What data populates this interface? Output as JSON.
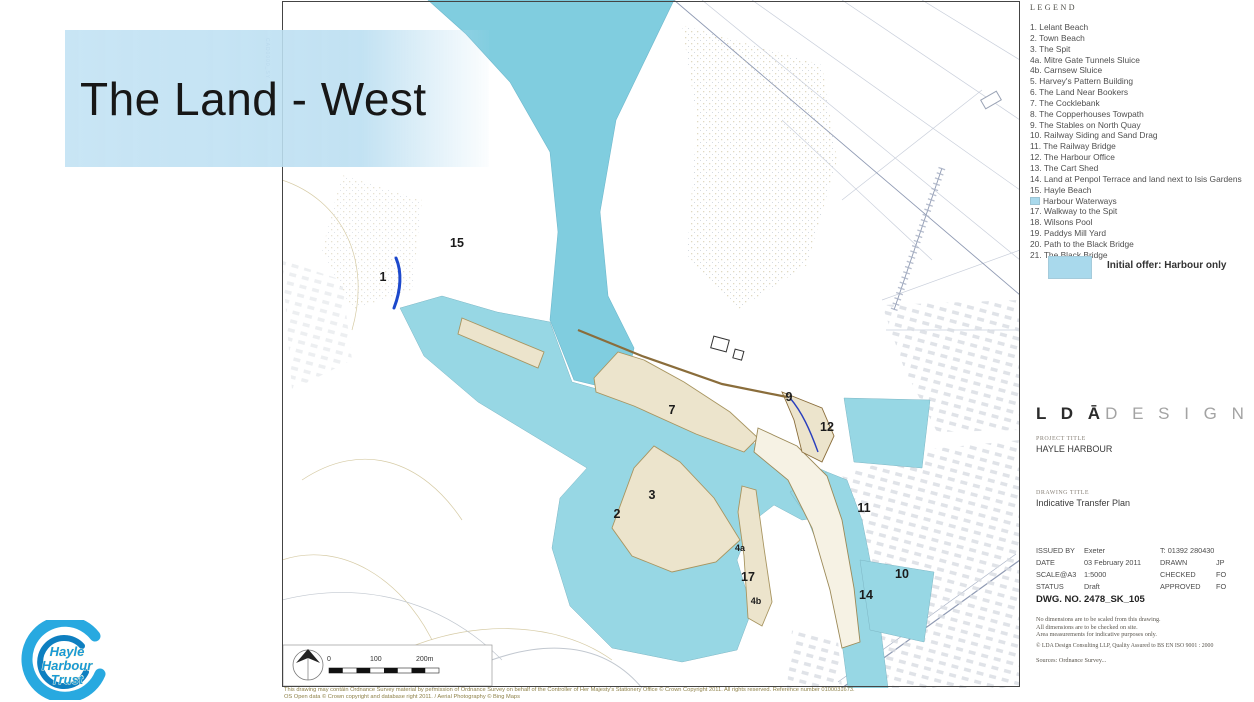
{
  "slide": {
    "title": "The Land - West"
  },
  "legend": {
    "heading": "LEGEND",
    "items": [
      {
        "text": "1. Lelant Beach"
      },
      {
        "text": "2. Town Beach"
      },
      {
        "text": "3. The Spit"
      },
      {
        "text": "4a. Mitre Gate Tunnels Sluice"
      },
      {
        "text": "4b. Carnsew Sluice"
      },
      {
        "text": "5. Harvey's Pattern Building"
      },
      {
        "text": "6. The Land Near Bookers"
      },
      {
        "text": "7. The Cocklebank"
      },
      {
        "text": "8. The Copperhouses Towpath"
      },
      {
        "text": "9. The Stables on North Quay"
      },
      {
        "text": "10. Railway Siding and Sand Drag"
      },
      {
        "text": "11. The Railway Bridge"
      },
      {
        "text": "12. The Harbour Office"
      },
      {
        "text": "13. The Cart Shed"
      },
      {
        "text": "14. Land at Penpol Terrace and land next to Isis Gardens"
      },
      {
        "text": "15. Hayle Beach"
      },
      {
        "swatch": true,
        "text": "Harbour Waterways"
      },
      {
        "text": "17. Walkway to the Spit"
      },
      {
        "text": "18. Wilsons Pool"
      },
      {
        "text": "19. Paddys Mill Yard"
      },
      {
        "text": "20. Path to the Black Bridge"
      },
      {
        "text": "21. The Black Bridge"
      }
    ],
    "offer_label": "Initial offer: Harbour only"
  },
  "titleblock": {
    "logo_dark": "L D Ā",
    "logo_light": "D E S I G N",
    "project_title_label": "PROJECT TITLE",
    "project_title": "HAYLE HARBOUR",
    "drawing_title_label": "DRAWING TITLE",
    "drawing_title": "Indicative Transfer Plan",
    "meta": [
      [
        "ISSUED BY",
        "Exeter",
        "T: 01392 280430",
        ""
      ],
      [
        "DATE",
        "03 February 2011",
        "DRAWN",
        "JP"
      ],
      [
        "SCALE@A3",
        "1:5000",
        "CHECKED",
        "FO"
      ],
      [
        "STATUS",
        "Draft",
        "APPROVED",
        "FO"
      ]
    ],
    "dwg_no": "DWG. NO. 2478_SK_105",
    "notes": [
      "No dimensions are to be scaled from this drawing.",
      "All dimensions are to be checked on site.",
      "Area measurements for indicative purposes only."
    ],
    "copyright": "© LDA Design Consulting LLP,  Quality Assured to BS EN ISO 9001 : 2000",
    "sources": "Sources: Ordnance Survey..."
  },
  "map": {
    "labels": [
      {
        "text": "15"
      },
      {
        "text": "1"
      },
      {
        "text": "7"
      },
      {
        "text": "9"
      },
      {
        "text": "12"
      },
      {
        "text": "3"
      },
      {
        "text": "2"
      },
      {
        "text": "11"
      },
      {
        "text": "4a"
      },
      {
        "text": "17"
      },
      {
        "text": "10"
      },
      {
        "text": "4b"
      },
      {
        "text": "14"
      }
    ],
    "scale_ticks": [
      "0",
      "100",
      "200m"
    ],
    "margin_ref": "CAD0000_SY",
    "footnote1": "This drawing may contain Ordnance Survey material by permission of Ordnance Survey on behalf of the Controller of Her Majesty's Stationery Office © Crown Copyright 2011. All rights reserved. Reference number 0100031673.",
    "footnote2": "OS Open data © Crown copyright and database right 2011.   /   Aerial Photography © Bing Maps"
  },
  "trust_logo": {
    "line1": "Hayle",
    "line2": "Harbour",
    "line3": "Trust"
  },
  "colors": {
    "water": "#97d7e4",
    "initial_offer": "#80cddf",
    "swatch_blue": "#a9d9ec",
    "sand": "#ece4cc",
    "banner_blue": "#bade f1",
    "logo_blue": "#28a9e0"
  }
}
